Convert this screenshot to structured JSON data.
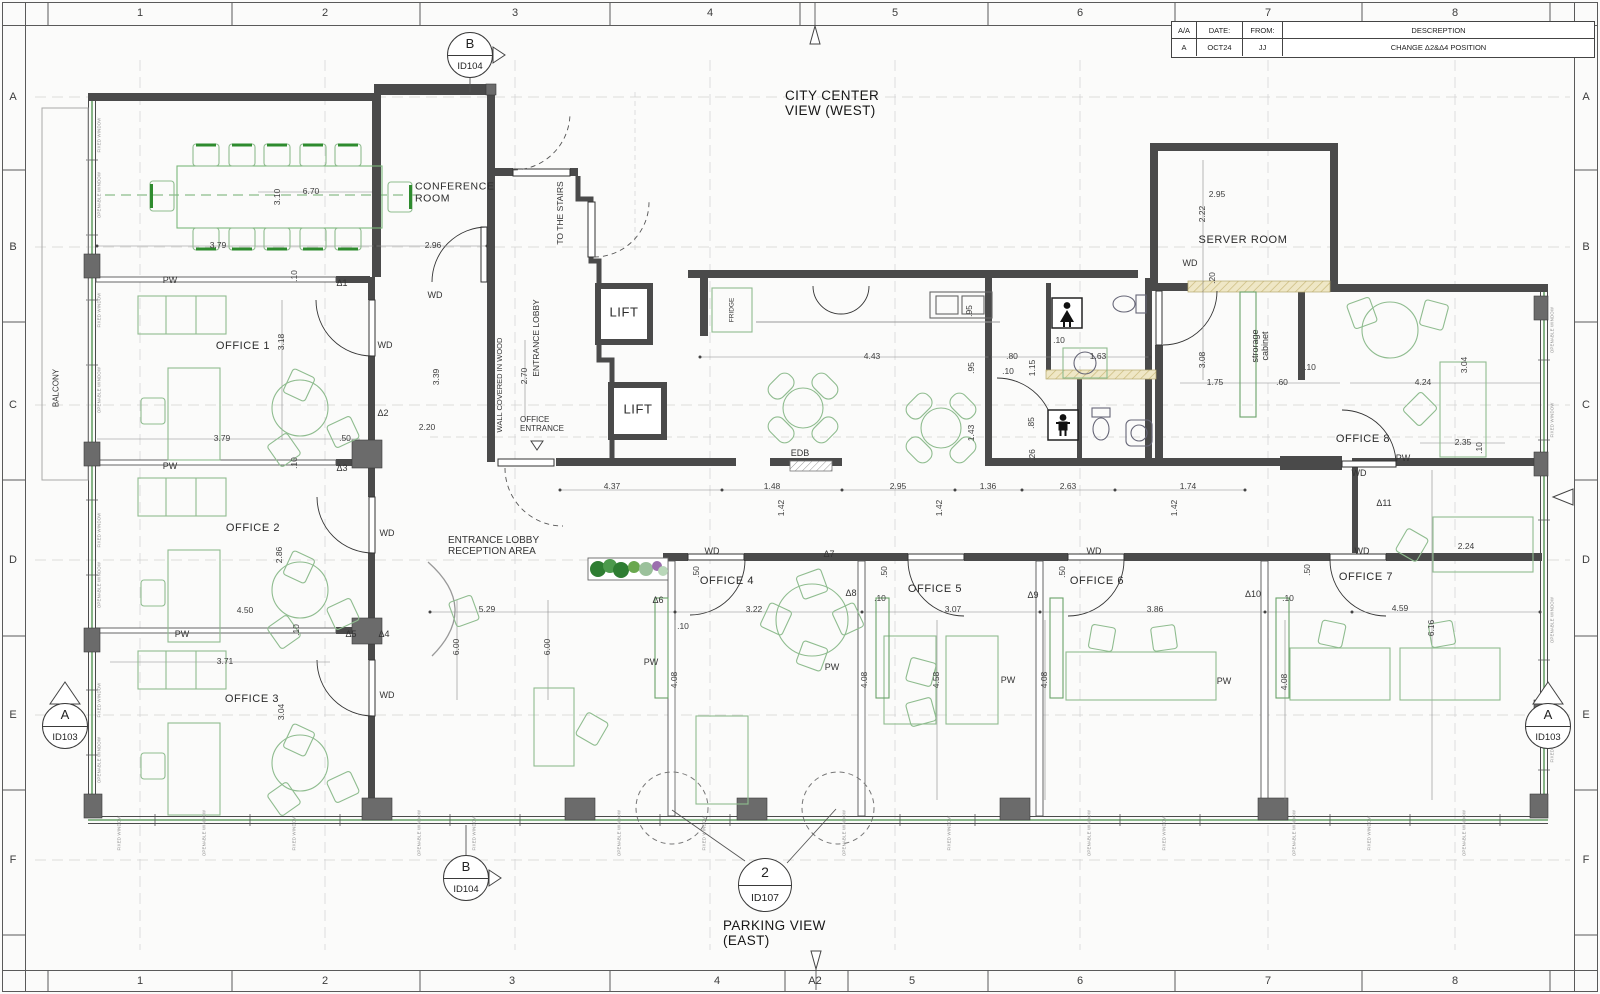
{
  "title_block": {
    "cols": [
      "A/A",
      "DATE:",
      "FROM:",
      "DESCREPTION"
    ],
    "row": [
      "A",
      "OCT24",
      "JJ",
      "CHANGE Δ2&Δ4 POSITION"
    ]
  },
  "markers": {
    "b_top": {
      "letter": "B",
      "id": "ID104"
    },
    "b_bottom": {
      "letter": "B",
      "id": "ID104"
    },
    "a_left": {
      "letter": "A",
      "id": "ID103"
    },
    "a_right": {
      "letter": "A",
      "id": "ID103"
    },
    "detail": {
      "number": "2",
      "id": "ID107"
    }
  },
  "plan": {
    "titles": [
      {
        "t": "CITY CENTER\nVIEW (WEST)",
        "x": 785,
        "y": 103,
        "a": "l"
      },
      {
        "t": "PARKING VIEW\n(EAST)",
        "x": 723,
        "y": 933,
        "a": "l"
      }
    ],
    "rooms": [
      {
        "t": "CONFERENCE\nROOM",
        "x": 415,
        "y": 193,
        "a": "l",
        "s": 10.5
      },
      {
        "t": "OFFICE 1",
        "x": 243,
        "y": 346
      },
      {
        "t": "OFFICE 2",
        "x": 253,
        "y": 528
      },
      {
        "t": "OFFICE 3",
        "x": 252,
        "y": 699
      },
      {
        "t": "OFFICE 4",
        "x": 727,
        "y": 581
      },
      {
        "t": "OFFICE 5",
        "x": 935,
        "y": 589
      },
      {
        "t": "OFFICE 6",
        "x": 1097,
        "y": 581
      },
      {
        "t": "OFFICE 7",
        "x": 1366,
        "y": 577
      },
      {
        "t": "OFFICE 8",
        "x": 1363,
        "y": 439
      },
      {
        "t": "SERVER ROOM",
        "x": 1243,
        "y": 240
      },
      {
        "t": "LIFT",
        "x": 624,
        "y": 313,
        "s": 13
      },
      {
        "t": "LIFT",
        "x": 638,
        "y": 410,
        "s": 13
      }
    ],
    "small_labels": [
      {
        "t": "ENTRANCE LOBBY",
        "x": 537,
        "y": 338,
        "r": 90
      },
      {
        "t": "TO THE STAIRS",
        "x": 561,
        "y": 213,
        "r": 90
      },
      {
        "t": "WALL COVERED IN WOOD",
        "x": 500,
        "y": 385,
        "r": 90,
        "s": 7.5
      },
      {
        "t": "OFFICE\nENTRANCE",
        "x": 520,
        "y": 425,
        "a": "l",
        "s": 8
      },
      {
        "t": "ENTRANCE LOBBY\nRECEPTION AREA",
        "x": 448,
        "y": 546,
        "a": "l",
        "s": 10
      },
      {
        "t": "BALCONY",
        "x": 57,
        "y": 388,
        "r": 90,
        "s": 8
      },
      {
        "t": "FRIDGE",
        "x": 732,
        "y": 310,
        "r": 90,
        "s": 6.5
      },
      {
        "t": "EDB",
        "x": 800,
        "y": 453,
        "s": 9
      },
      {
        "t": "strorage\ncabinet",
        "x": 1260,
        "y": 346,
        "r": 90,
        "s": 9
      }
    ],
    "deltas": [
      {
        "t": "Δ1",
        "x": 342,
        "y": 283
      },
      {
        "t": "Δ2",
        "x": 383,
        "y": 413
      },
      {
        "t": "Δ3",
        "x": 342,
        "y": 468
      },
      {
        "t": "Δ4",
        "x": 384,
        "y": 634
      },
      {
        "t": "Δ5",
        "x": 351,
        "y": 634
      },
      {
        "t": "Δ6",
        "x": 658,
        "y": 600
      },
      {
        "t": "Δ7",
        "x": 829,
        "y": 554
      },
      {
        "t": "Δ8",
        "x": 851,
        "y": 593
      },
      {
        "t": "Δ9",
        "x": 1033,
        "y": 595
      },
      {
        "t": "Δ10",
        "x": 1253,
        "y": 594
      },
      {
        "t": "Δ11",
        "x": 1384,
        "y": 503
      }
    ],
    "pw_labels": [
      {
        "t": "PW",
        "x": 170,
        "y": 280
      },
      {
        "t": "PW",
        "x": 170,
        "y": 466
      },
      {
        "t": "PW",
        "x": 182,
        "y": 634
      },
      {
        "t": "PW",
        "x": 651,
        "y": 662
      },
      {
        "t": "PW",
        "x": 832,
        "y": 667
      },
      {
        "t": "PW",
        "x": 1008,
        "y": 680
      },
      {
        "t": "PW",
        "x": 1224,
        "y": 681
      },
      {
        "t": "PW",
        "x": 1403,
        "y": 458
      }
    ],
    "wd_labels": [
      {
        "t": "WD",
        "x": 435,
        "y": 295
      },
      {
        "t": "WD",
        "x": 385,
        "y": 345
      },
      {
        "t": "WD",
        "x": 387,
        "y": 533
      },
      {
        "t": "WD",
        "x": 387,
        "y": 695
      },
      {
        "t": "WD",
        "x": 712,
        "y": 551
      },
      {
        "t": "WD",
        "x": 1094,
        "y": 551
      },
      {
        "t": "WD",
        "x": 1362,
        "y": 551
      },
      {
        "t": "WD",
        "x": 1359,
        "y": 473
      },
      {
        "t": "WD",
        "x": 1190,
        "y": 263
      }
    ],
    "dims": [
      {
        "t": "3.10",
        "x": 278,
        "y": 197,
        "r": 90
      },
      {
        "t": "6.70",
        "x": 311,
        "y": 192
      },
      {
        "t": "3.79",
        "x": 218,
        "y": 246
      },
      {
        "t": "2.96",
        "x": 433,
        "y": 246
      },
      {
        "t": ".10",
        "x": 295,
        "y": 276,
        "r": 90
      },
      {
        "t": "3.18",
        "x": 282,
        "y": 342,
        "r": 90
      },
      {
        "t": "3.79",
        "x": 222,
        "y": 439
      },
      {
        "t": ".50",
        "x": 345,
        "y": 439
      },
      {
        "t": ".10",
        "x": 295,
        "y": 463,
        "r": 90
      },
      {
        "t": "2.86",
        "x": 280,
        "y": 555,
        "r": 90
      },
      {
        "t": "4.50",
        "x": 245,
        "y": 611
      },
      {
        "t": ".10",
        "x": 297,
        "y": 630,
        "r": 90
      },
      {
        "t": "3.71",
        "x": 225,
        "y": 662
      },
      {
        "t": "3.04",
        "x": 282,
        "y": 712,
        "r": 90
      },
      {
        "t": "2.20",
        "x": 427,
        "y": 428
      },
      {
        "t": "2.70",
        "x": 525,
        "y": 376,
        "r": 90
      },
      {
        "t": "3.39",
        "x": 437,
        "y": 377,
        "r": 90
      },
      {
        "t": "5.29",
        "x": 487,
        "y": 610
      },
      {
        "t": "6.00",
        "x": 457,
        "y": 647,
        "r": 90
      },
      {
        "t": "6.00",
        "x": 548,
        "y": 647,
        "r": 90
      },
      {
        "t": "4.37",
        "x": 612,
        "y": 487
      },
      {
        "t": "1.48",
        "x": 772,
        "y": 487
      },
      {
        "t": "2.95",
        "x": 898,
        "y": 487
      },
      {
        "t": "1.36",
        "x": 988,
        "y": 487
      },
      {
        "t": "2.63",
        "x": 1068,
        "y": 487
      },
      {
        "t": "1.74",
        "x": 1188,
        "y": 487
      },
      {
        "t": "1.42",
        "x": 782,
        "y": 508,
        "r": 90
      },
      {
        "t": "1.42",
        "x": 940,
        "y": 508,
        "r": 90
      },
      {
        "t": "1.42",
        "x": 1175,
        "y": 508,
        "r": 90
      },
      {
        "t": "4.43",
        "x": 872,
        "y": 357
      },
      {
        "t": ".95",
        "x": 970,
        "y": 311,
        "r": 90
      },
      {
        "t": ".95",
        "x": 972,
        "y": 368,
        "r": 90
      },
      {
        "t": ".80",
        "x": 1012,
        "y": 357
      },
      {
        "t": ".10",
        "x": 1008,
        "y": 372
      },
      {
        "t": "1.63",
        "x": 1098,
        "y": 357
      },
      {
        "t": "1.15",
        "x": 1033,
        "y": 368,
        "r": 90
      },
      {
        "t": ".10",
        "x": 1059,
        "y": 341
      },
      {
        "t": ".85",
        "x": 1032,
        "y": 423,
        "r": 90
      },
      {
        "t": ".26",
        "x": 1033,
        "y": 455,
        "r": 90
      },
      {
        "t": "1.43",
        "x": 972,
        "y": 433,
        "r": 90
      },
      {
        "t": "2.95",
        "x": 1217,
        "y": 195
      },
      {
        "t": "2.22",
        "x": 1203,
        "y": 214,
        "r": 90
      },
      {
        "t": ".20",
        "x": 1213,
        "y": 278,
        "r": 90
      },
      {
        "t": "3.08",
        "x": 1203,
        "y": 360,
        "r": 90
      },
      {
        "t": "1.75",
        "x": 1215,
        "y": 383
      },
      {
        "t": ".60",
        "x": 1282,
        "y": 383
      },
      {
        "t": ".10",
        "x": 1310,
        "y": 368
      },
      {
        "t": "4.24",
        "x": 1423,
        "y": 383
      },
      {
        "t": "3.04",
        "x": 1465,
        "y": 365,
        "r": 90
      },
      {
        "t": "2.35",
        "x": 1463,
        "y": 443
      },
      {
        "t": ".10",
        "x": 1480,
        "y": 448,
        "r": 90
      },
      {
        "t": "2.24",
        "x": 1466,
        "y": 547
      },
      {
        "t": ".50",
        "x": 1308,
        "y": 570,
        "r": 90
      },
      {
        "t": "3.22",
        "x": 754,
        "y": 610
      },
      {
        "t": ".10",
        "x": 683,
        "y": 627
      },
      {
        "t": ".50",
        "x": 697,
        "y": 572,
        "r": 90
      },
      {
        "t": ".10",
        "x": 880,
        "y": 599
      },
      {
        "t": "3.07",
        "x": 953,
        "y": 610
      },
      {
        "t": ".50",
        "x": 885,
        "y": 572,
        "r": 90
      },
      {
        "t": ".50",
        "x": 1063,
        "y": 572,
        "r": 90
      },
      {
        "t": "3.86",
        "x": 1155,
        "y": 610
      },
      {
        "t": ".10",
        "x": 1288,
        "y": 599
      },
      {
        "t": "4.59",
        "x": 1400,
        "y": 609
      },
      {
        "t": "4.08",
        "x": 675,
        "y": 680,
        "r": 90
      },
      {
        "t": "4.08",
        "x": 865,
        "y": 680,
        "r": 90
      },
      {
        "t": "4.58",
        "x": 937,
        "y": 680,
        "r": 90
      },
      {
        "t": "4.08",
        "x": 1045,
        "y": 680,
        "r": 90
      },
      {
        "t": "4.08",
        "x": 1285,
        "y": 682,
        "r": 90
      },
      {
        "t": "6.16",
        "x": 1432,
        "y": 628,
        "r": 90
      }
    ],
    "window_labels": [
      {
        "t": "FIXED WINDOW",
        "x": 100,
        "y": 135,
        "r": 90
      },
      {
        "t": "OPENABLE WINDOW",
        "x": 100,
        "y": 195,
        "r": 90
      },
      {
        "t": "FIXED WINDOW",
        "x": 100,
        "y": 310,
        "r": 90
      },
      {
        "t": "OPENABLE WINDOW",
        "x": 100,
        "y": 390,
        "r": 90
      },
      {
        "t": "FIXED WINDOW",
        "x": 100,
        "y": 530,
        "r": 90
      },
      {
        "t": "OPENABLE WINDOW",
        "x": 100,
        "y": 585,
        "r": 90
      },
      {
        "t": "FIXED WINDOW",
        "x": 100,
        "y": 700,
        "r": 90
      },
      {
        "t": "OPENABLE WINDOW",
        "x": 100,
        "y": 760,
        "r": 90
      },
      {
        "t": "FIXED WINDOW",
        "x": 120,
        "y": 833,
        "r": 90
      },
      {
        "t": "OPENABLE WINDOW",
        "x": 205,
        "y": 833,
        "r": 90
      },
      {
        "t": "FIXED WINDOW",
        "x": 295,
        "y": 833,
        "r": 90
      },
      {
        "t": "OPENABLE WINDOW",
        "x": 420,
        "y": 833,
        "r": 90
      },
      {
        "t": "FIXED WINDOW",
        "x": 475,
        "y": 833,
        "r": 90
      },
      {
        "t": "OPENABLE WINDOW",
        "x": 620,
        "y": 833,
        "r": 90
      },
      {
        "t": "FIXED WINDOW",
        "x": 705,
        "y": 833,
        "r": 90
      },
      {
        "t": "OPENABLE WINDOW",
        "x": 845,
        "y": 833,
        "r": 90
      },
      {
        "t": "FIXED WINDOW",
        "x": 950,
        "y": 833,
        "r": 90
      },
      {
        "t": "OPENABLE WINDOW",
        "x": 1090,
        "y": 833,
        "r": 90
      },
      {
        "t": "FIXED WINDOW",
        "x": 1165,
        "y": 833,
        "r": 90
      },
      {
        "t": "OPENABLE WINDOW",
        "x": 1295,
        "y": 833,
        "r": 90
      },
      {
        "t": "FIXED WINDOW",
        "x": 1370,
        "y": 833,
        "r": 90
      },
      {
        "t": "OPENABLE WINDOW",
        "x": 1465,
        "y": 833,
        "r": 90
      },
      {
        "t": "OPENABLE WINDOW",
        "x": 1553,
        "y": 330,
        "r": 90
      },
      {
        "t": "FIXED WINDOW",
        "x": 1553,
        "y": 420,
        "r": 90
      },
      {
        "t": "OPENABLE WINDOW",
        "x": 1553,
        "y": 620,
        "r": 90
      },
      {
        "t": "FIXED WINDOW",
        "x": 1553,
        "y": 745,
        "r": 90
      }
    ],
    "grid_labels": [
      {
        "t": "1",
        "x": 140,
        "y": 13
      },
      {
        "t": "2",
        "x": 325,
        "y": 13
      },
      {
        "t": "3",
        "x": 515,
        "y": 13
      },
      {
        "t": "4",
        "x": 710,
        "y": 13
      },
      {
        "t": "5",
        "x": 895,
        "y": 13
      },
      {
        "t": "6",
        "x": 1080,
        "y": 13
      },
      {
        "t": "7",
        "x": 1268,
        "y": 13
      },
      {
        "t": "8",
        "x": 1455,
        "y": 13
      },
      {
        "t": "1",
        "x": 140,
        "y": 981
      },
      {
        "t": "2",
        "x": 325,
        "y": 981
      },
      {
        "t": "3",
        "x": 512,
        "y": 981
      },
      {
        "t": "4",
        "x": 717,
        "y": 981
      },
      {
        "t": "A2",
        "x": 815,
        "y": 981
      },
      {
        "t": "5",
        "x": 912,
        "y": 981
      },
      {
        "t": "6",
        "x": 1080,
        "y": 981
      },
      {
        "t": "7",
        "x": 1268,
        "y": 981
      },
      {
        "t": "8",
        "x": 1455,
        "y": 981
      },
      {
        "t": "A",
        "x": 13,
        "y": 97
      },
      {
        "t": "B",
        "x": 13,
        "y": 247
      },
      {
        "t": "C",
        "x": 13,
        "y": 405
      },
      {
        "t": "D",
        "x": 13,
        "y": 560
      },
      {
        "t": "E",
        "x": 13,
        "y": 715
      },
      {
        "t": "F",
        "x": 13,
        "y": 860
      },
      {
        "t": "A",
        "x": 1586,
        "y": 97
      },
      {
        "t": "B",
        "x": 1586,
        "y": 247
      },
      {
        "t": "C",
        "x": 1586,
        "y": 405
      },
      {
        "t": "D",
        "x": 1586,
        "y": 560
      },
      {
        "t": "E",
        "x": 1586,
        "y": 715
      },
      {
        "t": "F",
        "x": 1586,
        "y": 860
      }
    ]
  }
}
